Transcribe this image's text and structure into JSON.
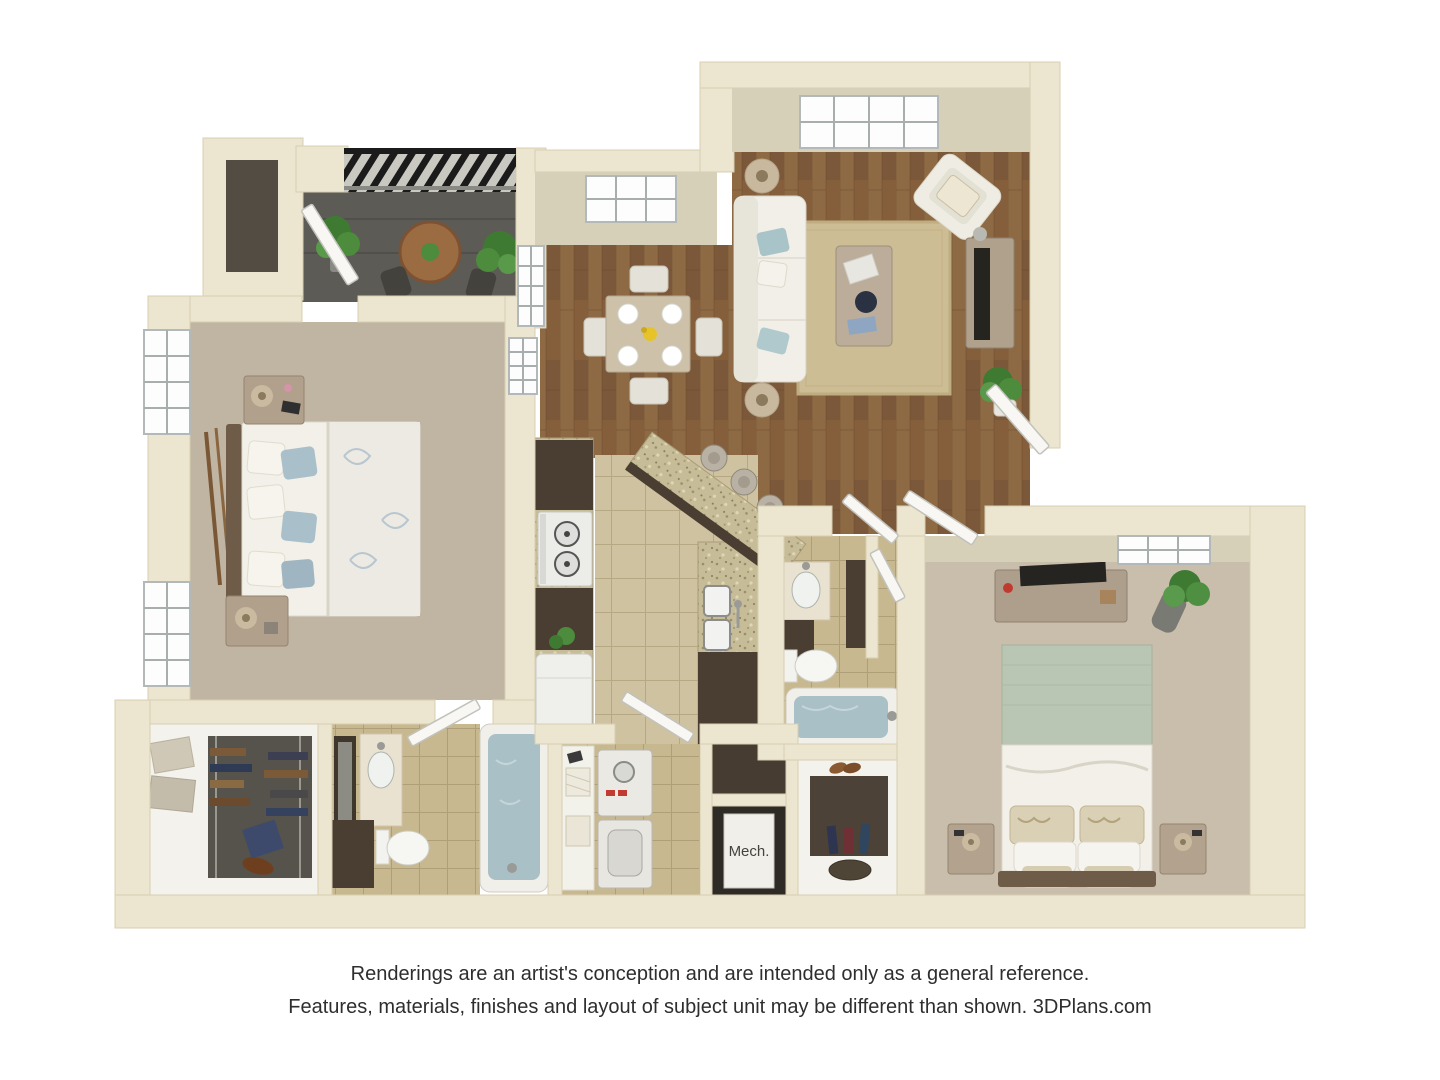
{
  "image_type": "3D apartment floor plan rendering",
  "labels": {
    "mech_room": "Mech."
  },
  "disclaimer": {
    "line1": "Renderings are an artist's conception and are intended only as a general reference.",
    "line2": "Features, materials, finishes and layout of subject unit may be different than shown. 3DPlans.com"
  },
  "branding": {
    "site": "3DPlans.com"
  },
  "rooms": [
    {
      "id": "balcony",
      "name": "Balcony",
      "furniture": [
        "round-bistro-table",
        "two-chairs",
        "potted-plants",
        "black-railing"
      ]
    },
    {
      "id": "living-room",
      "name": "Living Room",
      "furniture": [
        "sofa",
        "accent-chair",
        "coffee-table",
        "tv-console",
        "area-rug",
        "floor-lamps",
        "potted-plant",
        "window"
      ]
    },
    {
      "id": "dining-area",
      "name": "Dining Area",
      "furniture": [
        "square-table",
        "four-chairs",
        "place-settings",
        "flowers",
        "window"
      ]
    },
    {
      "id": "kitchen",
      "name": "Kitchen",
      "furniture": [
        "range",
        "refrigerator",
        "double-sink",
        "granite-counters",
        "breakfast-bar",
        "bar-stools",
        "dark-cabinets"
      ]
    },
    {
      "id": "bedroom-1",
      "name": "Bedroom 1",
      "furniture": [
        "bed",
        "two-nightstands",
        "lamps",
        "curtain-rods",
        "two-windows"
      ]
    },
    {
      "id": "bathroom-1",
      "name": "Bathroom 1",
      "furniture": [
        "vanity-mirror",
        "sink",
        "toilet",
        "bathtub"
      ]
    },
    {
      "id": "walk-in-closet",
      "name": "Walk-in Closet",
      "furniture": [
        "hanging-clothes",
        "storage-boxes",
        "shoes"
      ]
    },
    {
      "id": "laundry",
      "name": "Laundry",
      "furniture": [
        "washer",
        "dryer",
        "towel-shelf"
      ]
    },
    {
      "id": "mech-room",
      "name": "Mechanical Room",
      "label": "Mech."
    },
    {
      "id": "closet-2",
      "name": "Closet",
      "furniture": [
        "hanging-clothes",
        "shoes",
        "bag"
      ]
    },
    {
      "id": "bathroom-2",
      "name": "Bathroom 2",
      "furniture": [
        "vanity",
        "sink",
        "toilet",
        "bathtub"
      ]
    },
    {
      "id": "bedroom-2",
      "name": "Bedroom 2",
      "furniture": [
        "bed",
        "two-nightstands",
        "dresser",
        "tv",
        "potted-plant",
        "window"
      ]
    }
  ],
  "palette": {
    "wall": "#ECE5CF",
    "wall_face": "#D6D0B9",
    "wood_floor": "#855F3C",
    "kitchen_tile": "#CEC2A0",
    "bath_tile": "#C8B88F",
    "carpet_bedroom_1": "#C0B4A2",
    "carpet_bedroom_2": "#C9BDAB",
    "closet_floor": "#F3F2EC",
    "balcony_floor": "#5C5B56",
    "cabinets_dark": "#4A3D31",
    "granite": "#C7BC98",
    "tub_water": "#A9C0C6",
    "sofa": "#F1EFE7",
    "rug": "#CDBD95",
    "blanket_green": "#B9C6B3",
    "accent_pillow_blue": "#A9BFCA",
    "plant_green": "#4C8C3C",
    "railing_black": "#1B1B1B",
    "door_white": "#F8F7F3",
    "text": "#2E2E2E"
  }
}
